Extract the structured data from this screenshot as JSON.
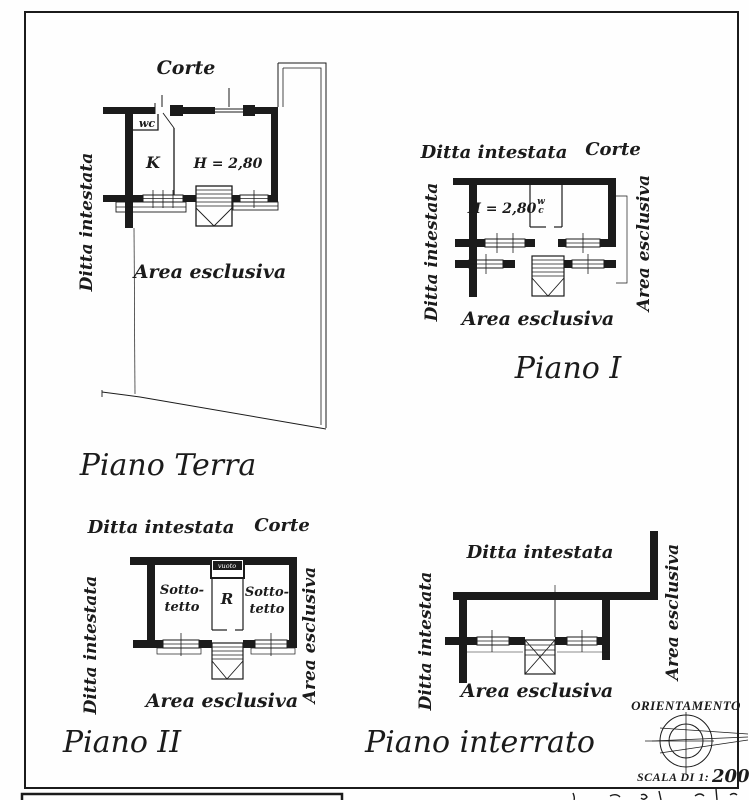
{
  "colors": {
    "paper": "#fefefe",
    "ink": "#1b1b1b"
  },
  "plans": {
    "terra": {
      "title": "Piano Terra",
      "corte": "Corte",
      "ditta_intestata": "Ditta intestata",
      "area_esclusiva": "Area esclusiva",
      "room_k": "K",
      "room_wc": "wc",
      "height": "H = 2,80"
    },
    "primo": {
      "title": "Piano I",
      "ditta_intestata_top": "Ditta intestata",
      "corte": "Corte",
      "ditta_intestata_left": "Ditta intestata",
      "area_esclusiva_right": "Area esclusiva",
      "area_esclusiva_bottom": "Area esclusiva",
      "height": "H = 2,80",
      "wc_line1": "w",
      "wc_line2": "c"
    },
    "secondo": {
      "title": "Piano II",
      "ditta_intestata_top": "Ditta intestata",
      "corte": "Corte",
      "ditta_intestata_left": "Ditta intestata",
      "area_esclusiva_right": "Area esclusiva",
      "area_esclusiva_bottom": "Area esclusiva",
      "sottotetto_line1": "Sotto-",
      "sottotetto_line2": "tetto",
      "room_r": "R",
      "vuoto": "vuoto"
    },
    "interrato": {
      "title": "Piano interrato",
      "ditta_intestata_top": "Ditta intestata",
      "ditta_intestata_left": "Ditta intestata",
      "area_esclusiva_right": "Area esclusiva",
      "area_esclusiva_bottom": "Area esclusiva"
    }
  },
  "orientation": {
    "label": "ORIENTAMENTO",
    "scale_prefix": "SCALA DI 1:",
    "scale_value": "200"
  }
}
